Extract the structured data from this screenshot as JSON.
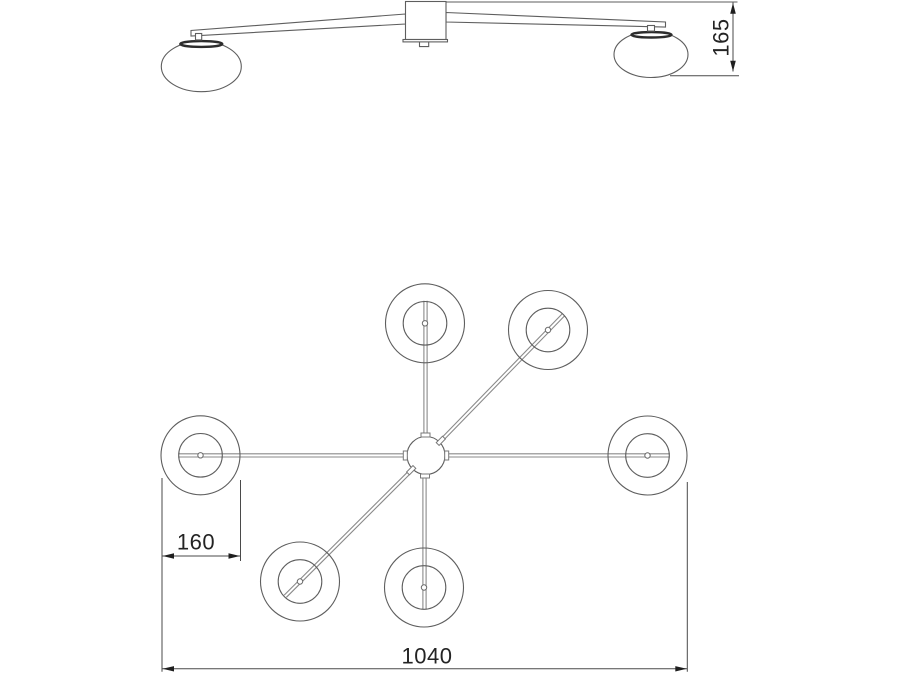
{
  "drawing": {
    "kind": "ceiling-lamp-technical-drawing",
    "background": "#ffffff",
    "colors": {
      "outline": "#5e5e5e",
      "thin_arm": "#8a8a8a",
      "dimension": "#4a4a4a",
      "arrow": "#1f1f1f",
      "text": "#242424",
      "shade_rim": "#2c2c2c"
    },
    "side_view": {
      "height_dimension_label": "165"
    },
    "plan_view": {
      "shade_dimension_label": "160",
      "overall_width_dimension_label": "1040"
    }
  }
}
